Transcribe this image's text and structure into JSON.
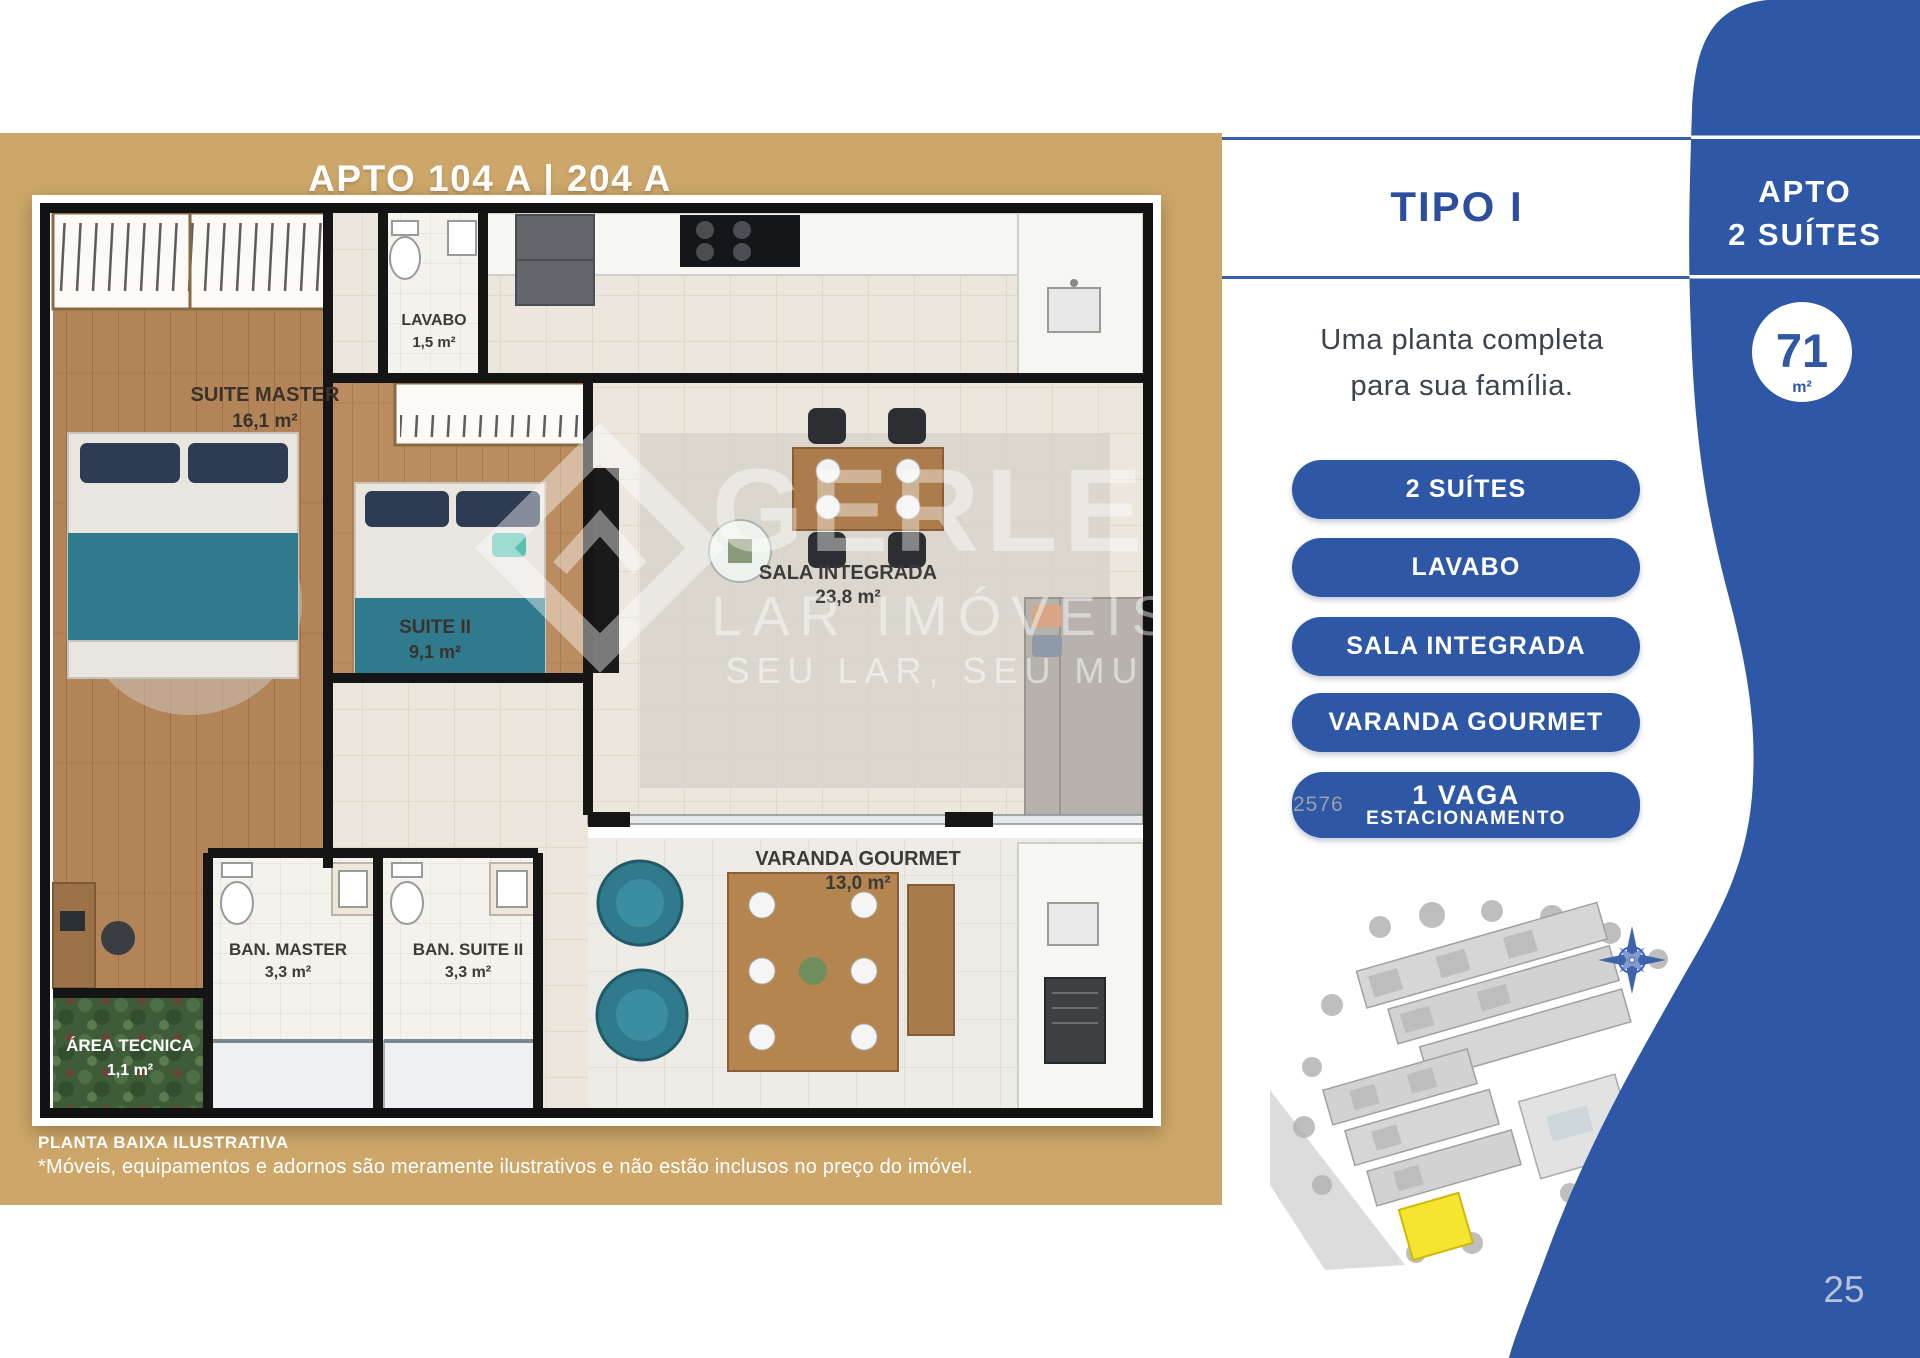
{
  "panel_left": {
    "title": "APTO 104 A | 204 A",
    "rooms": [
      {
        "name": "SUITE MASTER",
        "area": "16,1 m²"
      },
      {
        "name": "LAVABO",
        "area": "1,5 m²"
      },
      {
        "name": "SUITE II",
        "area": "9,1 m²"
      },
      {
        "name": "SALA INTEGRADA",
        "area": "23,8 m²"
      },
      {
        "name": "BAN. MASTER",
        "area": "3,3 m²"
      },
      {
        "name": "BAN. SUITE II",
        "area": "3,3 m²"
      },
      {
        "name": "ÁREA TECNICA",
        "area": "1,1 m²"
      },
      {
        "name": "VARANDA GOURMET",
        "area": "13,0 m²"
      }
    ],
    "footnote_title": "PLANTA BAIXA ILUSTRATIVA",
    "footnote_text": "*Móveis, equipamentos e adornos são meramente ilustrativos e não estão inclusos no preço do imóvel."
  },
  "watermark": {
    "brand": "GERLE",
    "line2": "LAR IMÓVEIS",
    "line3": "SEU LAR, SEU MU",
    "code": "2576"
  },
  "panel_info": {
    "heading": "TIPO I",
    "tagline_line1": "Uma planta completa",
    "tagline_line2": "para sua família.",
    "features": [
      "2 SUÍTES",
      "LAVABO",
      "SALA INTEGRADA",
      "VARANDA GOURMET"
    ],
    "feature_parking": {
      "line1": "1 VAGA",
      "line2": "ESTACIONAMENTO"
    }
  },
  "panel_side": {
    "apto_line1": "APTO",
    "apto_line2": "2 SUÍTES",
    "area_value": "71",
    "area_unit": "m²",
    "page_number": "25"
  },
  "colors": {
    "tan": "#cda76a",
    "blue": "#2e57a5",
    "heading_blue": "#2c4e9d",
    "teal_furniture": "#2f7b8d",
    "map_highlight": "#f6e52e"
  }
}
